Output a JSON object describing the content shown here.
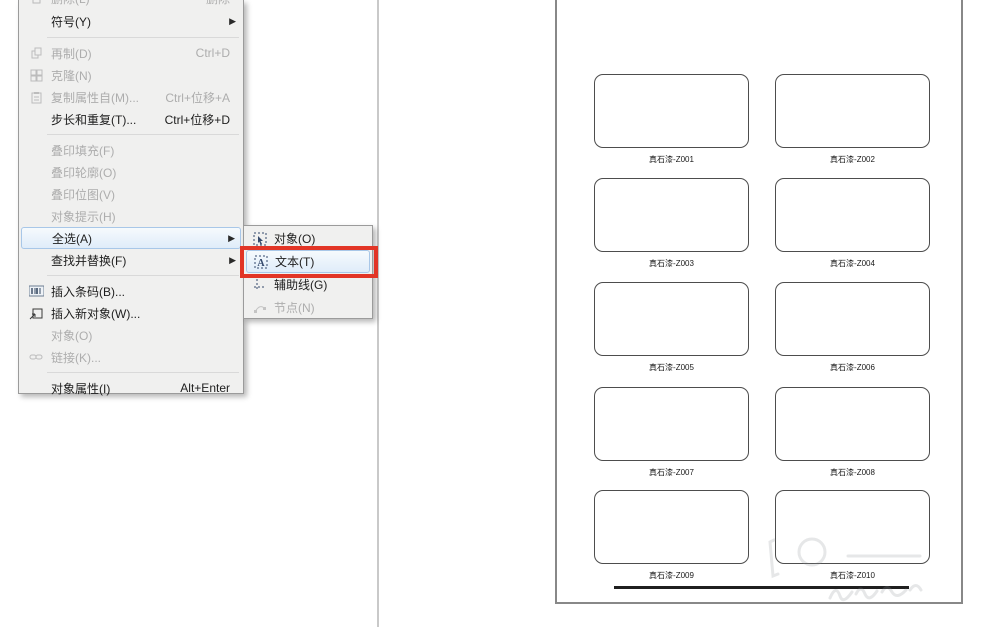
{
  "menu": {
    "items": [
      {
        "label": "删除(L)",
        "shortcut": "删除",
        "state": "disabled"
      },
      {
        "label": "符号(Y)",
        "state": "enabled",
        "has_submenu": true
      },
      {
        "label": "再制(D)",
        "shortcut": "Ctrl+D",
        "state": "disabled"
      },
      {
        "label": "克隆(N)",
        "state": "disabled"
      },
      {
        "label": "复制属性自(M)...",
        "shortcut": "Ctrl+位移+A",
        "state": "disabled"
      },
      {
        "label": "步长和重复(T)...",
        "shortcut": "Ctrl+位移+D",
        "state": "enabled"
      },
      {
        "label": "叠印填充(F)",
        "state": "disabled"
      },
      {
        "label": "叠印轮廓(O)",
        "state": "disabled"
      },
      {
        "label": "叠印位图(V)",
        "state": "disabled"
      },
      {
        "label": "对象提示(H)",
        "state": "disabled"
      },
      {
        "label": "全选(A)",
        "state": "hovered",
        "has_submenu": true
      },
      {
        "label": "查找并替换(F)",
        "state": "enabled",
        "has_submenu": true
      },
      {
        "label": "插入条码(B)...",
        "state": "enabled"
      },
      {
        "label": "插入新对象(W)...",
        "state": "enabled"
      },
      {
        "label": "对象(O)",
        "state": "disabled"
      },
      {
        "label": "链接(K)...",
        "state": "disabled"
      },
      {
        "label": "对象属性(I)",
        "shortcut": "Alt+Enter",
        "state": "enabled"
      }
    ],
    "arrow_glyph": "▶"
  },
  "submenu": {
    "items": [
      {
        "label": "对象(O)",
        "state": "enabled"
      },
      {
        "label": "文本(T)",
        "state": "highlighted-by-red-annotation"
      },
      {
        "label": "辅助线(G)",
        "state": "enabled"
      },
      {
        "label": "节点(N)",
        "state": "disabled"
      }
    ]
  },
  "annotation": {
    "color": "#e23526",
    "target": "文本(T)"
  },
  "page": {
    "swatches": [
      {
        "label": "真石漆-Z001"
      },
      {
        "label": "真石漆-Z002"
      },
      {
        "label": "真石漆-Z003"
      },
      {
        "label": "真石漆-Z004"
      },
      {
        "label": "真石漆-Z005"
      },
      {
        "label": "真石漆-Z006"
      },
      {
        "label": "真石漆-Z007"
      },
      {
        "label": "真石漆-Z008"
      },
      {
        "label": "真石漆-Z009"
      },
      {
        "label": "真石漆-Z010"
      }
    ]
  }
}
